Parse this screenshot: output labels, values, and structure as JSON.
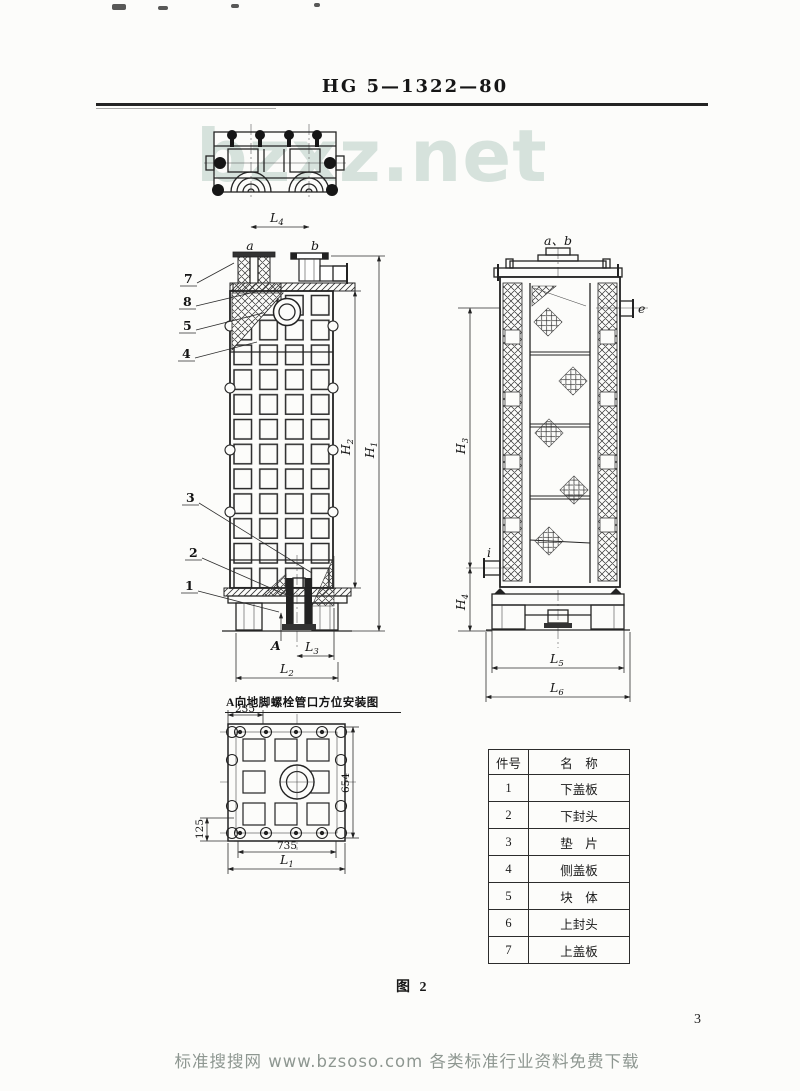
{
  "page": {
    "header_code": "HG 5—1322—80",
    "figure_caption": "图 2",
    "page_number": "3",
    "watermark_large": "bzxz.net",
    "watermark_bottom": "标准搜搜网 www.bzsoso.com 各类标准行业资料免费下载"
  },
  "front": {
    "nozzle_a": "a",
    "nozzle_b": "b",
    "view_arrow": "A",
    "callouts": {
      "c7": "7",
      "c8": "8",
      "c5": "5",
      "c4": "4",
      "c3": "3",
      "c2": "2",
      "c1": "1"
    },
    "dims": {
      "L4": {
        "m": "L",
        "s": "4"
      },
      "H2": {
        "m": "H",
        "s": "2"
      },
      "H1": {
        "m": "H",
        "s": "1"
      },
      "L3": {
        "m": "L",
        "s": "3"
      },
      "L2": {
        "m": "L",
        "s": "2"
      }
    }
  },
  "side": {
    "top_label": "a、b",
    "nozzle_e": "e",
    "nozzle_i": "i",
    "dims": {
      "H3": {
        "m": "H",
        "s": "3"
      },
      "H4": {
        "m": "H",
        "s": "4"
      },
      "L5": {
        "m": "L",
        "s": "5"
      },
      "L6": {
        "m": "L",
        "s": "6"
      }
    }
  },
  "bottom_view": {
    "caption": "A向地脚螺栓管口方位安装图",
    "dims": {
      "w235": "235",
      "w125": "125",
      "w735": "735",
      "h654": "654",
      "L1": {
        "m": "L",
        "s": "1"
      }
    }
  },
  "parts_table": {
    "col_no": "件号",
    "col_name": "名　称",
    "rows": [
      {
        "no": "1",
        "name": "下盖板"
      },
      {
        "no": "2",
        "name": "下封头"
      },
      {
        "no": "3",
        "name": "垫　片"
      },
      {
        "no": "4",
        "name": "侧盖板"
      },
      {
        "no": "5",
        "name": "块　体"
      },
      {
        "no": "6",
        "name": "上封头"
      },
      {
        "no": "7",
        "name": "上盖板"
      }
    ]
  },
  "colors": {
    "ink": "#242424",
    "watermark_large": "#d6e2dc",
    "watermark_bottom": "#8e9791",
    "paper": "#fcfcfa"
  }
}
